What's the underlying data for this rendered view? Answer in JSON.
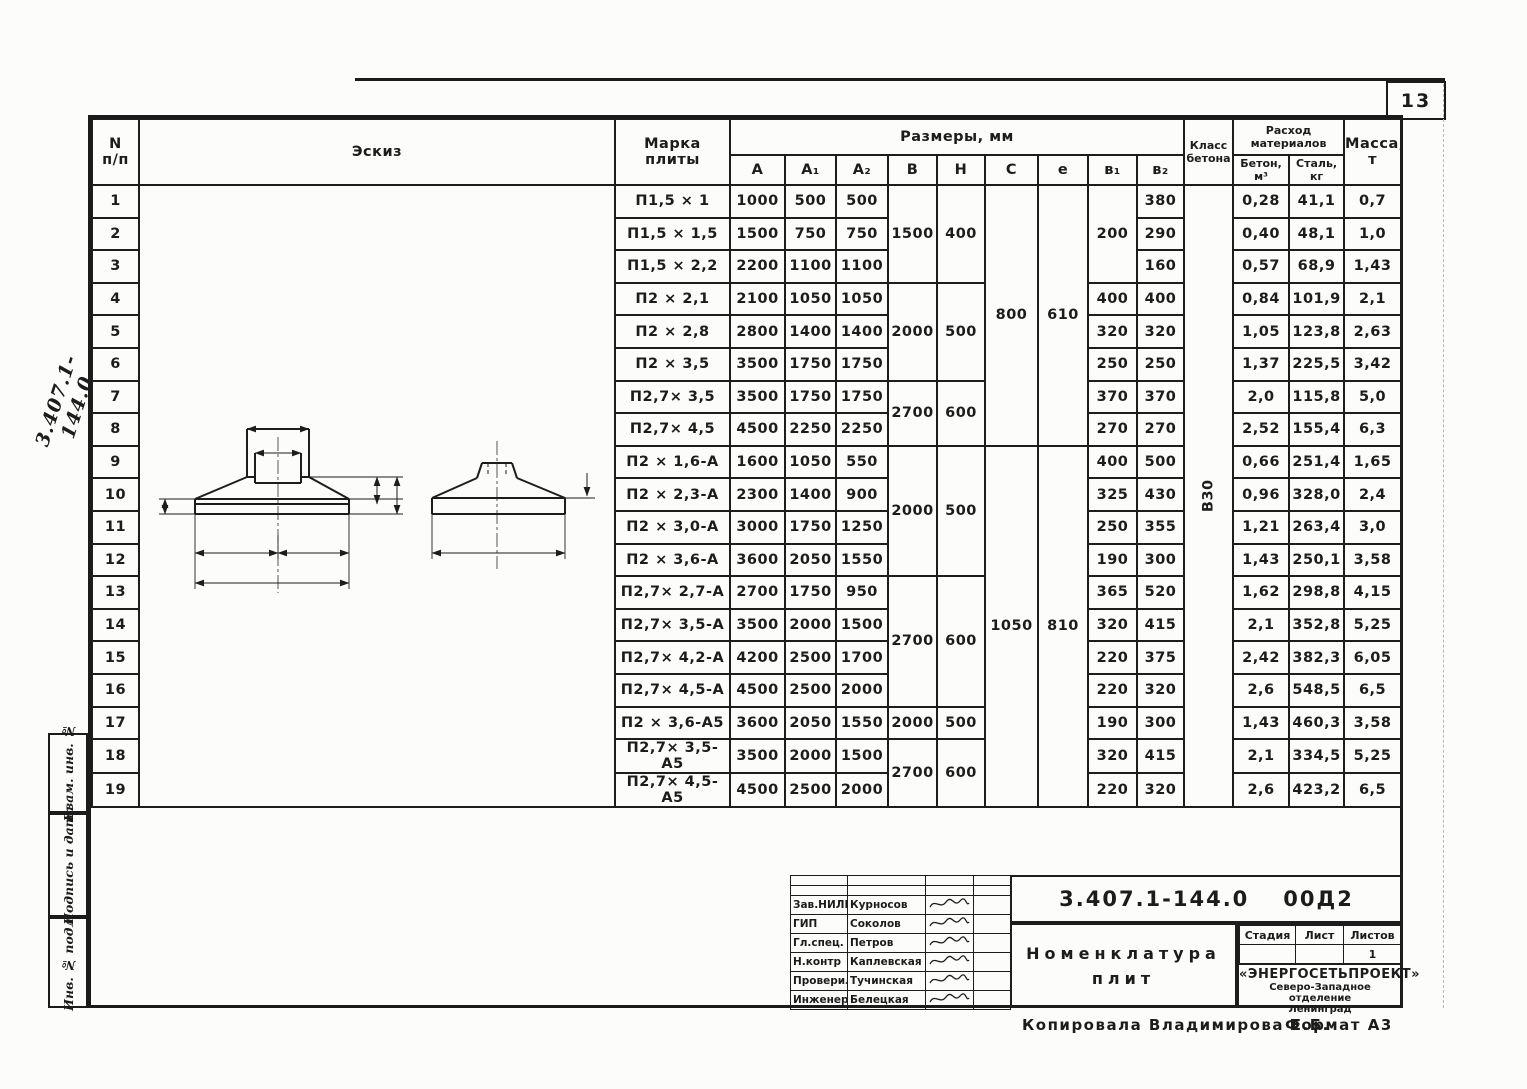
{
  "page": {
    "number": "13",
    "copied_by": "Копировала  Владимирова Е.Б.",
    "format": "Формат А3",
    "margin_code": "3.407.1-144.0"
  },
  "left_strip": {
    "items": [
      "Взам. инв. №",
      "Подпись и дата",
      "Инв. № подл."
    ]
  },
  "table": {
    "num_header": [
      "N",
      "п/п"
    ],
    "sketch_header": "Эскиз",
    "mark_header": [
      "Марка",
      "плиты"
    ],
    "sizes_header": "Размеры,  мм",
    "size_cols": [
      "A",
      "A₁",
      "A₂",
      "B",
      "H",
      "C",
      "e",
      "в₁",
      "в₂"
    ],
    "class_header": [
      "Класс",
      "бетона"
    ],
    "materials_header": [
      "Расход",
      "материалов"
    ],
    "concrete_header": [
      "Бетон,",
      "м³"
    ],
    "steel_header": [
      "Сталь,",
      "кг"
    ],
    "mass_header": [
      "Масса,",
      "т"
    ],
    "concrete_class": "В30",
    "body": [
      {
        "n": "1",
        "mark": "П1,5 × 1",
        "cells": [
          {
            "v": "1000"
          },
          {
            "v": "500"
          },
          {
            "v": "500"
          },
          {
            "v": "1500",
            "rs": 3
          },
          {
            "v": "400",
            "rs": 3
          },
          {
            "v": "800",
            "rs": 8,
            "cls": "ptop"
          },
          {
            "v": "610",
            "rs": 8,
            "cls": "ptop"
          },
          {
            "v": "200",
            "rs": 3
          },
          {
            "v": "380"
          },
          {
            "v": "В30",
            "rs": 19,
            "cls": "vert"
          },
          {
            "v": "0,28"
          },
          {
            "v": "41,1"
          },
          {
            "v": "0,7"
          }
        ]
      },
      {
        "n": "2",
        "mark": "П1,5 × 1,5",
        "cells": [
          {
            "v": "1500"
          },
          {
            "v": "750"
          },
          {
            "v": "750"
          },
          {
            "v": "290"
          },
          {
            "v": "0,40"
          },
          {
            "v": "48,1"
          },
          {
            "v": "1,0"
          }
        ]
      },
      {
        "n": "3",
        "mark": "П1,5 × 2,2",
        "cells": [
          {
            "v": "2200"
          },
          {
            "v": "1100"
          },
          {
            "v": "1100"
          },
          {
            "v": "160"
          },
          {
            "v": "0,57"
          },
          {
            "v": "68,9"
          },
          {
            "v": "1,43"
          }
        ]
      },
      {
        "n": "4",
        "mark": "П2 × 2,1",
        "cells": [
          {
            "v": "2100"
          },
          {
            "v": "1050"
          },
          {
            "v": "1050"
          },
          {
            "v": "2000",
            "rs": 3
          },
          {
            "v": "500",
            "rs": 3
          },
          {
            "v": "400"
          },
          {
            "v": "400"
          },
          {
            "v": "0,84"
          },
          {
            "v": "101,9"
          },
          {
            "v": "2,1"
          }
        ]
      },
      {
        "n": "5",
        "mark": "П2 × 2,8",
        "cells": [
          {
            "v": "2800"
          },
          {
            "v": "1400"
          },
          {
            "v": "1400"
          },
          {
            "v": "320"
          },
          {
            "v": "320"
          },
          {
            "v": "1,05"
          },
          {
            "v": "123,8"
          },
          {
            "v": "2,63"
          }
        ]
      },
      {
        "n": "6",
        "mark": "П2 × 3,5",
        "cells": [
          {
            "v": "3500"
          },
          {
            "v": "1750"
          },
          {
            "v": "1750"
          },
          {
            "v": "250"
          },
          {
            "v": "250"
          },
          {
            "v": "1,37"
          },
          {
            "v": "225,5"
          },
          {
            "v": "3,42"
          }
        ]
      },
      {
        "n": "7",
        "mark": "П2,7× 3,5",
        "cells": [
          {
            "v": "3500"
          },
          {
            "v": "1750"
          },
          {
            "v": "1750"
          },
          {
            "v": "2700",
            "rs": 2
          },
          {
            "v": "600",
            "rs": 2
          },
          {
            "v": "370"
          },
          {
            "v": "370"
          },
          {
            "v": "2,0"
          },
          {
            "v": "115,8"
          },
          {
            "v": "5,0"
          }
        ]
      },
      {
        "n": "8",
        "mark": "П2,7× 4,5",
        "cells": [
          {
            "v": "4500"
          },
          {
            "v": "2250"
          },
          {
            "v": "2250"
          },
          {
            "v": "270"
          },
          {
            "v": "270"
          },
          {
            "v": "2,52"
          },
          {
            "v": "155,4"
          },
          {
            "v": "6,3"
          }
        ]
      },
      {
        "n": "9",
        "mark": "П2 × 1,6-А",
        "cells": [
          {
            "v": "1600"
          },
          {
            "v": "1050"
          },
          {
            "v": "550"
          },
          {
            "v": "2000",
            "rs": 4
          },
          {
            "v": "500",
            "rs": 4
          },
          {
            "v": "1050",
            "rs": 11,
            "cls": "ptop"
          },
          {
            "v": "810",
            "rs": 11,
            "cls": "ptop"
          },
          {
            "v": "400"
          },
          {
            "v": "500"
          },
          {
            "v": "0,66"
          },
          {
            "v": "251,4"
          },
          {
            "v": "1,65"
          }
        ]
      },
      {
        "n": "10",
        "mark": "П2 × 2,3-А",
        "cells": [
          {
            "v": "2300"
          },
          {
            "v": "1400"
          },
          {
            "v": "900"
          },
          {
            "v": "325"
          },
          {
            "v": "430"
          },
          {
            "v": "0,96"
          },
          {
            "v": "328,0"
          },
          {
            "v": "2,4"
          }
        ]
      },
      {
        "n": "11",
        "mark": "П2 × 3,0-А",
        "cells": [
          {
            "v": "3000"
          },
          {
            "v": "1750"
          },
          {
            "v": "1250"
          },
          {
            "v": "250"
          },
          {
            "v": "355"
          },
          {
            "v": "1,21"
          },
          {
            "v": "263,4"
          },
          {
            "v": "3,0"
          }
        ]
      },
      {
        "n": "12",
        "mark": "П2 × 3,6-А",
        "cells": [
          {
            "v": "3600"
          },
          {
            "v": "2050"
          },
          {
            "v": "1550"
          },
          {
            "v": "190"
          },
          {
            "v": "300"
          },
          {
            "v": "1,43"
          },
          {
            "v": "250,1"
          },
          {
            "v": "3,58"
          }
        ]
      },
      {
        "n": "13",
        "mark": "П2,7× 2,7-А",
        "cells": [
          {
            "v": "2700"
          },
          {
            "v": "1750"
          },
          {
            "v": "950"
          },
          {
            "v": "2700",
            "rs": 4
          },
          {
            "v": "600",
            "rs": 4
          },
          {
            "v": "365"
          },
          {
            "v": "520"
          },
          {
            "v": "1,62"
          },
          {
            "v": "298,8"
          },
          {
            "v": "4,15"
          }
        ]
      },
      {
        "n": "14",
        "mark": "П2,7× 3,5-А",
        "cells": [
          {
            "v": "3500"
          },
          {
            "v": "2000"
          },
          {
            "v": "1500"
          },
          {
            "v": "320"
          },
          {
            "v": "415"
          },
          {
            "v": "2,1"
          },
          {
            "v": "352,8"
          },
          {
            "v": "5,25"
          }
        ]
      },
      {
        "n": "15",
        "mark": "П2,7× 4,2-А",
        "cells": [
          {
            "v": "4200"
          },
          {
            "v": "2500"
          },
          {
            "v": "1700"
          },
          {
            "v": "220"
          },
          {
            "v": "375"
          },
          {
            "v": "2,42"
          },
          {
            "v": "382,3"
          },
          {
            "v": "6,05"
          }
        ]
      },
      {
        "n": "16",
        "mark": "П2,7× 4,5-А",
        "cells": [
          {
            "v": "4500"
          },
          {
            "v": "2500"
          },
          {
            "v": "2000"
          },
          {
            "v": "220"
          },
          {
            "v": "320"
          },
          {
            "v": "2,6"
          },
          {
            "v": "548,5"
          },
          {
            "v": "6,5"
          }
        ]
      },
      {
        "n": "17",
        "mark": "П2 × 3,6-А5",
        "cells": [
          {
            "v": "3600"
          },
          {
            "v": "2050"
          },
          {
            "v": "1550"
          },
          {
            "v": "2000"
          },
          {
            "v": "500"
          },
          {
            "v": "190"
          },
          {
            "v": "300"
          },
          {
            "v": "1,43"
          },
          {
            "v": "460,3"
          },
          {
            "v": "3,58"
          }
        ]
      },
      {
        "n": "18",
        "mark": "П2,7× 3,5-А5",
        "cells": [
          {
            "v": "3500"
          },
          {
            "v": "2000"
          },
          {
            "v": "1500"
          },
          {
            "v": "2700",
            "rs": 2
          },
          {
            "v": "600",
            "rs": 2
          },
          {
            "v": "320"
          },
          {
            "v": "415"
          },
          {
            "v": "2,1"
          },
          {
            "v": "334,5"
          },
          {
            "v": "5,25"
          }
        ]
      },
      {
        "n": "19",
        "mark": "П2,7× 4,5-А5",
        "cells": [
          {
            "v": "4500"
          },
          {
            "v": "2500"
          },
          {
            "v": "2000"
          },
          {
            "v": "220"
          },
          {
            "v": "320"
          },
          {
            "v": "2,6"
          },
          {
            "v": "423,2"
          },
          {
            "v": "6,5"
          }
        ]
      }
    ]
  },
  "sketch": {
    "c": "С",
    "e": "е",
    "b2": "в₂",
    "h": "Н",
    "b1": "в₁",
    "a1": "А₁",
    "a2": "А₂",
    "a": "А",
    "b": "В",
    "offset": "100"
  },
  "stamp": {
    "doc_number": "3.407.1-144.0",
    "doc_suffix": "00Д2",
    "title_lines": [
      "Номенклатура",
      "плит"
    ],
    "people": [
      {
        "role": "Зав.НИЛКЭ",
        "name": "Курносов"
      },
      {
        "role": "ГИП",
        "name": "Соколов"
      },
      {
        "role": "Гл.спец.",
        "name": "Петров"
      },
      {
        "role": "Н.контр",
        "name": "Каплевская"
      },
      {
        "role": "Проверила",
        "name": "Тучинская"
      },
      {
        "role": "Инженер",
        "name": "Белецкая"
      }
    ],
    "stage_headers": [
      "Стадия",
      "Лист",
      "Листов"
    ],
    "stage_values": [
      "",
      "",
      "1"
    ],
    "org_lines": [
      "«ЭНЕРГОСЕТЬПРОЕКТ»",
      "Северо-Западное отделение",
      "Ленинград"
    ]
  }
}
